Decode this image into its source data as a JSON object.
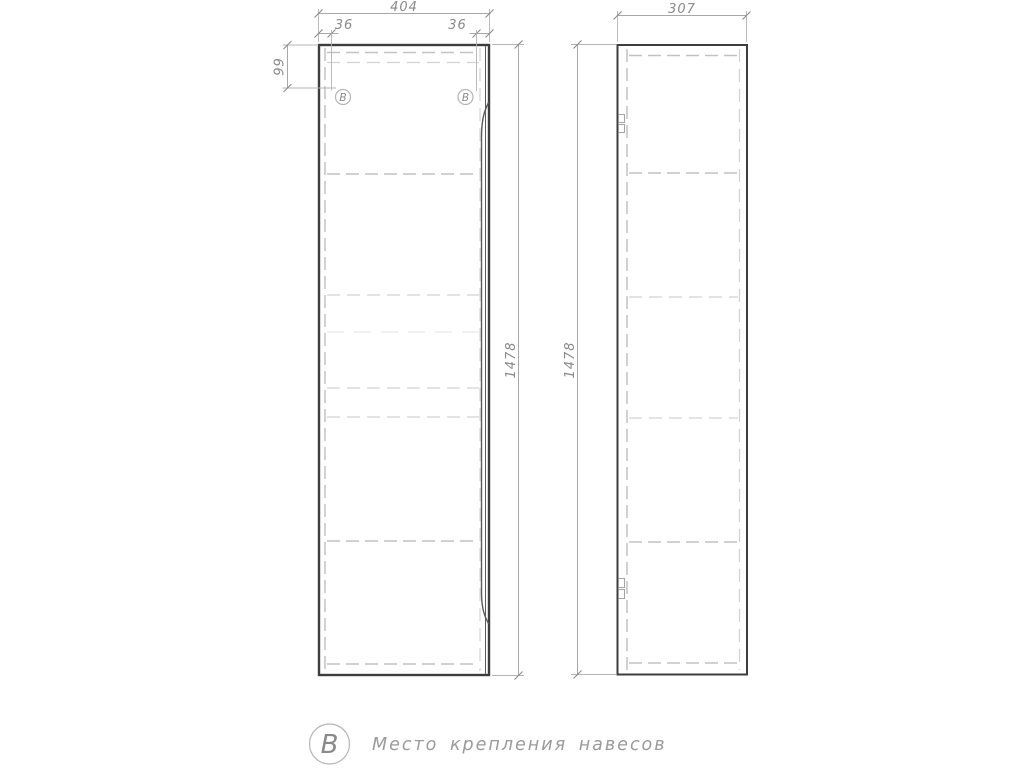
{
  "drawing": {
    "front_view": {
      "width_dim": "404",
      "hanger_offset_left": "36",
      "hanger_offset_right": "36",
      "hanger_top_offset": "99",
      "height_dim": "1478",
      "callout_left": "B",
      "callout_right": "B"
    },
    "side_view": {
      "depth_dim": "307",
      "height_dim": "1478"
    },
    "legend": {
      "symbol": "B",
      "description": "Место крепления навесов"
    },
    "colors": {
      "outline": "#3d3d3d",
      "hidden_line": "#c8c8c8",
      "dimension_line": "#a8a8a8",
      "text": "#8a8a8a",
      "callout_circle": "#b5b5b5"
    }
  }
}
